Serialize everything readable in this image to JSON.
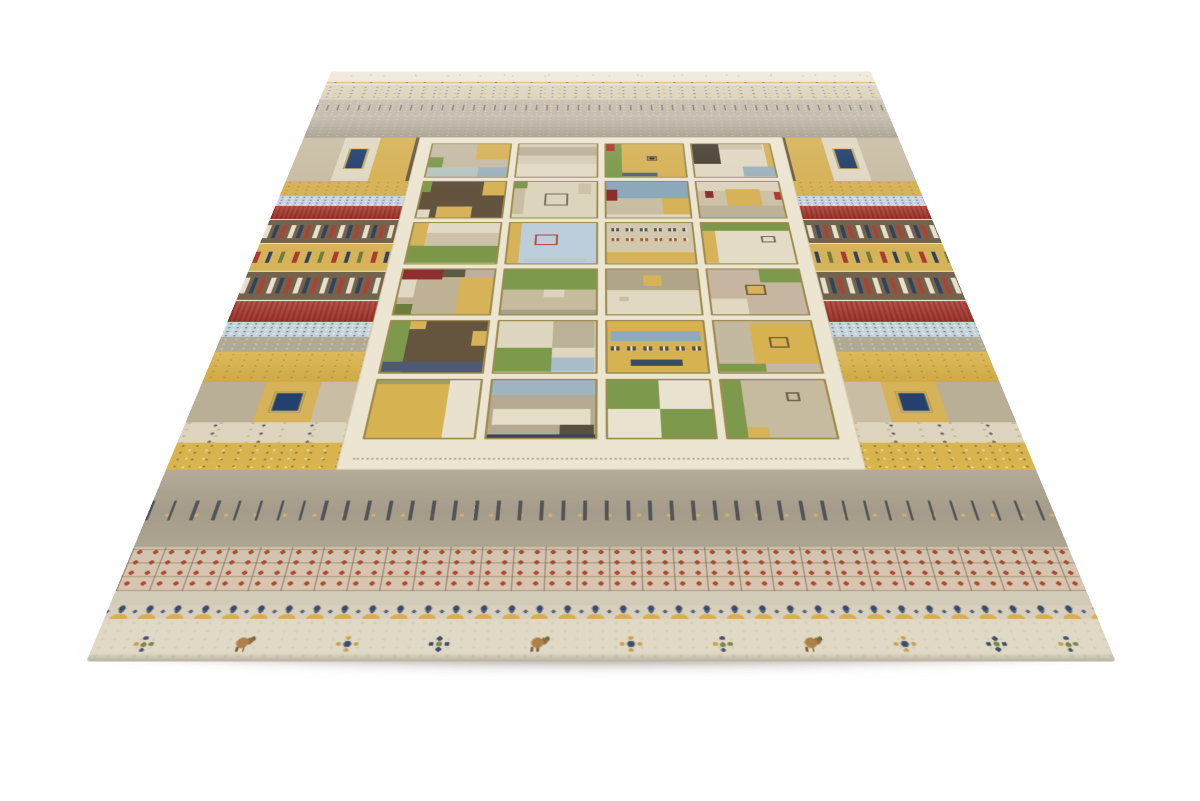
{
  "scene": {
    "description": "Beige Gabbeh-style patchwork wool area rug with multicolor stripes and a central grid of pictorial squares, photographed at an angle on a white background",
    "background": "#ffffff"
  },
  "rug": {
    "palette": {
      "cream_edge": "#eae3d0",
      "cream_panel": "#ece5d1",
      "bottom_cream": "#ded6c1",
      "gold": "#d6b258",
      "gold_deep": "#c9a33e",
      "red": "#ad3a30",
      "maroon": "#8c2f2e",
      "navy": "#2e3c5e",
      "brown": "#74634c",
      "green": "#7d9a4c",
      "blue_light": "#c6d3d9",
      "beige": "#d7ccb2",
      "taupe": "#b2a994",
      "pink_band": "#d3c0aa",
      "gray_wide": "#a89f8f"
    },
    "bands": [
      {
        "id": "edge-motif",
        "cls": "b-edge",
        "top": 0,
        "h": 24
      },
      {
        "id": "gold-dotline",
        "cls": "b-goldline",
        "top": 24,
        "h": 15
      },
      {
        "id": "beige-dots",
        "cls": "b-beigedots",
        "top": 39,
        "h": 41
      },
      {
        "id": "gray-dash",
        "cls": "b-dash",
        "top": 80,
        "h": 41
      },
      {
        "id": "gray-fade",
        "cls": "b-grayfade",
        "top": 121,
        "h": 57
      },
      {
        "id": "patch-a",
        "cls": "b-patch",
        "top": 178,
        "h": 100,
        "segments": [
          {
            "w": 7,
            "c": "#c9bda4",
            "p": "speck"
          },
          {
            "w": 6,
            "c": "#e0d8c3",
            "p": "dots",
            "sq": "#24406e"
          },
          {
            "w": 6,
            "c": "#d6b258",
            "p": "dots"
          },
          {
            "w": 7,
            "c": "#6b5a43",
            "p": "grid"
          },
          {
            "w": 6,
            "c": "#e0d8c3",
            "p": "dots"
          },
          {
            "w": 6,
            "c": "#d6b258",
            "p": "speck"
          },
          {
            "w": 24,
            "c": "#cfc4ab",
            "p": "speck"
          },
          {
            "w": 6,
            "c": "#d6b258",
            "p": "speck"
          },
          {
            "w": 6,
            "c": "#e0d8c3",
            "p": "dots"
          },
          {
            "w": 7,
            "c": "#6b5a43",
            "p": "grid"
          },
          {
            "w": 6,
            "c": "#d6b258",
            "p": "dots"
          },
          {
            "w": 6,
            "c": "#e0d8c3",
            "p": "dots",
            "sq": "#24406e"
          },
          {
            "w": 7,
            "c": "#c9bda4",
            "p": "speck"
          }
        ]
      },
      {
        "id": "gold-1",
        "cls": "b-gold",
        "top": 278,
        "h": 32
      },
      {
        "id": "bluedots-1",
        "cls": "b-bluedots",
        "top": 310,
        "h": 21
      },
      {
        "id": "red-1",
        "cls": "b-red",
        "top": 331,
        "h": 26
      },
      {
        "id": "kilim-1",
        "cls": "b-kilim",
        "top": 357,
        "h": 48
      },
      {
        "id": "gold-motifs",
        "cls": "b-goldmotifs",
        "top": 405,
        "h": 48
      },
      {
        "id": "kilim-2",
        "cls": "b-kilim",
        "top": 453,
        "h": 51
      },
      {
        "id": "red-2",
        "cls": "b-red",
        "top": 504,
        "h": 33
      },
      {
        "id": "bluedots-2",
        "cls": "b-bluedots",
        "top": 537,
        "h": 23
      },
      {
        "id": "gray-plain",
        "cls": "b-gray",
        "top": 560,
        "h": 22
      },
      {
        "id": "gold-wide",
        "cls": "b-goldwide",
        "top": 582,
        "h": 42
      },
      {
        "id": "patch-b",
        "cls": "b-patch",
        "top": 624,
        "h": 53,
        "segments": [
          {
            "w": 8,
            "c": "#b9ae96",
            "p": "speck"
          },
          {
            "w": 7,
            "c": "#d6b258",
            "p": "dots",
            "sq": "#24406e"
          },
          {
            "w": 8,
            "c": "#c9bda4",
            "p": "speck"
          },
          {
            "w": 8,
            "c": "#6b5a43",
            "p": "grid"
          },
          {
            "w": 8,
            "c": "#b9ae96",
            "p": "dots"
          },
          {
            "w": 22,
            "c": "#bdb29a",
            "p": "speck"
          },
          {
            "w": 8,
            "c": "#b9ae96",
            "p": "dots"
          },
          {
            "w": 8,
            "c": "#6b5a43",
            "p": "grid"
          },
          {
            "w": 8,
            "c": "#c9bda4",
            "p": "speck"
          },
          {
            "w": 7,
            "c": "#d6b258",
            "p": "dots",
            "sq": "#24406e"
          },
          {
            "w": 8,
            "c": "#b9ae96",
            "p": "speck"
          }
        ]
      },
      {
        "id": "cream-marks",
        "cls": "b-creammarks",
        "top": 677,
        "h": 25
      },
      {
        "id": "gold-speck",
        "cls": "b-goldspeck",
        "top": 702,
        "h": 32
      },
      {
        "id": "stick-row",
        "cls": "b-sticks",
        "top": 734,
        "h": 82
      },
      {
        "id": "pink-grid",
        "cls": "b-pinkgrid",
        "top": 816,
        "h": 42
      },
      {
        "id": "light-plain",
        "cls": "b-light",
        "top": 858,
        "h": 13
      },
      {
        "id": "flower-row",
        "cls": "b-flowers",
        "top": 871,
        "h": 12
      },
      {
        "id": "bottom-cream",
        "cls": "b-bottom",
        "top": 883,
        "h": 36
      }
    ],
    "bottom_motifs": [
      {
        "x": 5,
        "type": "plant"
      },
      {
        "x": 15,
        "type": "deer"
      },
      {
        "x": 25,
        "type": "diamond"
      },
      {
        "x": 34,
        "type": "cross"
      },
      {
        "x": 44,
        "type": "deer"
      },
      {
        "x": 53,
        "type": "diamond"
      },
      {
        "x": 62,
        "type": "plant"
      },
      {
        "x": 71,
        "type": "deer"
      },
      {
        "x": 80,
        "type": "diamond"
      },
      {
        "x": 89,
        "type": "cross"
      },
      {
        "x": 96,
        "type": "plant"
      }
    ],
    "grid_cells": [
      [
        [
          0,
          0,
          100,
          100,
          "#c6bba4",
          "speck"
        ],
        [
          58,
          0,
          42,
          48,
          "#d6b258",
          "dots"
        ],
        [
          0,
          42,
          18,
          30,
          "#7d9a4c",
          "dots"
        ],
        [
          0,
          72,
          100,
          28,
          "#b7c6c0",
          "dots"
        ],
        [
          64,
          72,
          36,
          28,
          "#9db3bd",
          "dots"
        ]
      ],
      [
        [
          0,
          0,
          100,
          100,
          "#d6cdb8",
          "dots"
        ],
        [
          0,
          10,
          100,
          26,
          "#bdb098",
          "frames"
        ],
        [
          0,
          62,
          100,
          38,
          "#e2dac5",
          "waves"
        ]
      ],
      [
        [
          0,
          0,
          100,
          100,
          "#d6b258",
          "speck"
        ],
        [
          0,
          0,
          20,
          100,
          "#7d9a4c",
          "dots"
        ],
        [
          0,
          0,
          12,
          22,
          "#ad3a30"
        ],
        [
          20,
          88,
          45,
          12,
          "#51648a"
        ],
        [
          52,
          38,
          14,
          14,
          "",
          "box"
        ],
        [
          56,
          42,
          6,
          6,
          "#2e2a22"
        ]
      ],
      [
        [
          0,
          0,
          100,
          100,
          "#e0d8c3",
          "dots"
        ],
        [
          0,
          0,
          34,
          62,
          "#4c4236",
          "grid"
        ],
        [
          34,
          0,
          56,
          18,
          "#cdc2a8",
          "speck"
        ],
        [
          60,
          70,
          40,
          30,
          "#9db3bd",
          "dots"
        ],
        [
          92,
          0,
          8,
          70,
          "#d6b258"
        ]
      ],
      [
        [
          0,
          0,
          100,
          100,
          "#64543f",
          "speck"
        ],
        [
          74,
          0,
          26,
          40,
          "#d6b258",
          "dots"
        ],
        [
          0,
          0,
          10,
          30,
          "#7d9a4c"
        ],
        [
          22,
          70,
          42,
          30,
          "#d6b258",
          "dots"
        ],
        [
          0,
          78,
          14,
          22,
          "#e0d8c3"
        ]
      ],
      [
        [
          0,
          0,
          100,
          100,
          "#ddd4bd",
          "dots"
        ],
        [
          0,
          0,
          16,
          20,
          "#7d9a4c"
        ],
        [
          0,
          20,
          14,
          70,
          "#c9bda2",
          "speck"
        ],
        [
          38,
          34,
          28,
          34,
          "",
          "box"
        ],
        [
          78,
          6,
          16,
          30,
          "#cdc2a8",
          "speck"
        ]
      ],
      [
        [
          0,
          0,
          100,
          100,
          "#c9bda2",
          "speck"
        ],
        [
          0,
          0,
          100,
          48,
          "#8ea8bb",
          "dots"
        ],
        [
          0,
          24,
          14,
          30,
          "#8c2f2e"
        ],
        [
          68,
          48,
          32,
          44,
          "#d6b258",
          "dots"
        ],
        [
          0,
          92,
          100,
          8,
          "#e0d8c3"
        ]
      ],
      [
        [
          0,
          0,
          100,
          100,
          "#cdc2a8",
          "dots"
        ],
        [
          0,
          0,
          100,
          26,
          "#ddd4bd",
          "dots"
        ],
        [
          8,
          28,
          10,
          18,
          "#8c2f2e"
        ],
        [
          34,
          22,
          42,
          46,
          "#d6b258",
          "dots"
        ],
        [
          92,
          30,
          8,
          22,
          "#ad3a30"
        ],
        [
          0,
          68,
          100,
          32,
          "#bdb298",
          "speck"
        ]
      ],
      [
        [
          0,
          0,
          100,
          100,
          "#e2dac5",
          "dots"
        ],
        [
          0,
          0,
          16,
          58,
          "#d6b258",
          "dots"
        ],
        [
          16,
          26,
          84,
          30,
          "#cdc2a8",
          "speck"
        ],
        [
          0,
          58,
          100,
          42,
          "#7b9747",
          "speck"
        ]
      ],
      [
        [
          0,
          0,
          100,
          100,
          "#bccedb",
          "plus"
        ],
        [
          0,
          0,
          14,
          100,
          "#d6b258",
          "dots"
        ],
        [
          30,
          30,
          26,
          26,
          "",
          "boxred"
        ],
        [
          20,
          88,
          70,
          10,
          "#b9c7d2",
          "framesred"
        ]
      ],
      [
        [
          0,
          0,
          100,
          100,
          "#d2c8ad",
          "dots"
        ],
        [
          6,
          8,
          88,
          18,
          "",
          "frames"
        ],
        [
          6,
          34,
          88,
          16,
          "",
          "framesred"
        ],
        [
          0,
          74,
          100,
          26,
          "#d6b258",
          "waves"
        ]
      ],
      [
        [
          0,
          0,
          100,
          100,
          "#e3dbc6",
          "dots"
        ],
        [
          0,
          0,
          100,
          20,
          "#7b9747",
          "speck"
        ],
        [
          0,
          20,
          14,
          80,
          "#d6b258",
          "dots"
        ],
        [
          66,
          34,
          16,
          16,
          "",
          "box"
        ]
      ],
      [
        [
          0,
          0,
          100,
          100,
          "#bfb294",
          "speck"
        ],
        [
          0,
          0,
          44,
          24,
          "#8c2f2e"
        ],
        [
          44,
          0,
          24,
          18,
          "#5c5a40"
        ],
        [
          64,
          18,
          36,
          82,
          "#d6b258",
          "dots"
        ],
        [
          0,
          24,
          16,
          40,
          "#e0d8c3"
        ],
        [
          0,
          78,
          18,
          22,
          "#6d7c3c"
        ]
      ],
      [
        [
          0,
          0,
          100,
          100,
          "#c7bb9e",
          "speck"
        ],
        [
          0,
          0,
          100,
          46,
          "#7d9a4c",
          "speck"
        ],
        [
          44,
          46,
          22,
          18,
          "#ddd4bd"
        ],
        [
          0,
          90,
          100,
          10,
          "#a79e8b"
        ]
      ],
      [
        [
          0,
          0,
          100,
          100,
          "#e0d8c3",
          "dots"
        ],
        [
          0,
          0,
          100,
          48,
          "#b0a489",
          "dots"
        ],
        [
          40,
          14,
          20,
          24,
          "#d6b258"
        ],
        [
          14,
          62,
          10,
          10,
          "#c9bda2"
        ]
      ],
      [
        [
          0,
          0,
          100,
          100,
          "#c6b5a0",
          "plus"
        ],
        [
          56,
          0,
          44,
          30,
          "#7d9a4c",
          "speck"
        ],
        [
          0,
          66,
          38,
          34,
          "#e0d8c3",
          "dots"
        ],
        [
          38,
          36,
          22,
          22,
          "#d6b258",
          "box"
        ]
      ],
      [
        [
          0,
          0,
          100,
          100,
          "#65553f",
          "speck"
        ],
        [
          0,
          0,
          20,
          100,
          "#7d9a4c",
          "dots"
        ],
        [
          20,
          0,
          16,
          16,
          "#d6b258"
        ],
        [
          86,
          20,
          14,
          30,
          "#d6b258",
          "dots"
        ],
        [
          0,
          80,
          100,
          20,
          "#4e5a74",
          "speck"
        ]
      ],
      [
        [
          0,
          0,
          100,
          100,
          "#ded6c0",
          "dots"
        ],
        [
          56,
          0,
          44,
          54,
          "#bbb098",
          "speck"
        ],
        [
          0,
          54,
          56,
          46,
          "#7d9a4c",
          "grid"
        ],
        [
          56,
          72,
          44,
          28,
          "#a8bdc8",
          "dots"
        ]
      ],
      [
        [
          0,
          0,
          100,
          100,
          "#d7b251",
          "dots"
        ],
        [
          4,
          20,
          92,
          20,
          "#8fa9c0",
          "frames"
        ],
        [
          4,
          46,
          92,
          18,
          "",
          "frames"
        ],
        [
          24,
          76,
          52,
          12,
          "#3a4a66",
          "waves"
        ]
      ],
      [
        [
          0,
          0,
          100,
          100,
          "#c3b8a0",
          "speck"
        ],
        [
          36,
          4,
          64,
          80,
          "#d7b251",
          "dots"
        ],
        [
          54,
          32,
          20,
          22,
          "",
          "box"
        ],
        [
          0,
          84,
          46,
          16,
          "#7d9a4c",
          "dots"
        ]
      ],
      [
        [
          0,
          0,
          100,
          100,
          "#d7b251",
          "dots"
        ],
        [
          70,
          0,
          30,
          100,
          "#e8e1cd",
          "diamonds"
        ],
        [
          0,
          0,
          70,
          7,
          "#9aa065"
        ]
      ],
      [
        [
          0,
          0,
          100,
          100,
          "#b5aa91",
          "speck"
        ],
        [
          0,
          0,
          100,
          28,
          "#9db4c2",
          "dots"
        ],
        [
          4,
          52,
          92,
          26,
          "#e5ddc8",
          "frames"
        ],
        [
          68,
          78,
          32,
          22,
          "#55503f"
        ],
        [
          0,
          94,
          100,
          6,
          "#3a4458"
        ]
      ],
      [
        [
          0,
          0,
          100,
          100,
          "#e5ddc8",
          "dots"
        ],
        [
          0,
          0,
          50,
          52,
          "#7d9a4c",
          "speck"
        ],
        [
          50,
          52,
          50,
          48,
          "#7d9a4c",
          "speck"
        ],
        [
          50,
          0,
          50,
          52,
          "#e9e2cf",
          "dots"
        ],
        [
          0,
          52,
          50,
          48,
          "#e9e2cf",
          "dots"
        ]
      ],
      [
        [
          0,
          0,
          100,
          100,
          "#c7bb9f",
          "speck"
        ],
        [
          0,
          0,
          18,
          100,
          "#7d9a4c",
          "dots"
        ],
        [
          18,
          82,
          20,
          18,
          "#d6b258"
        ],
        [
          60,
          22,
          14,
          16,
          "",
          "box"
        ]
      ]
    ]
  }
}
